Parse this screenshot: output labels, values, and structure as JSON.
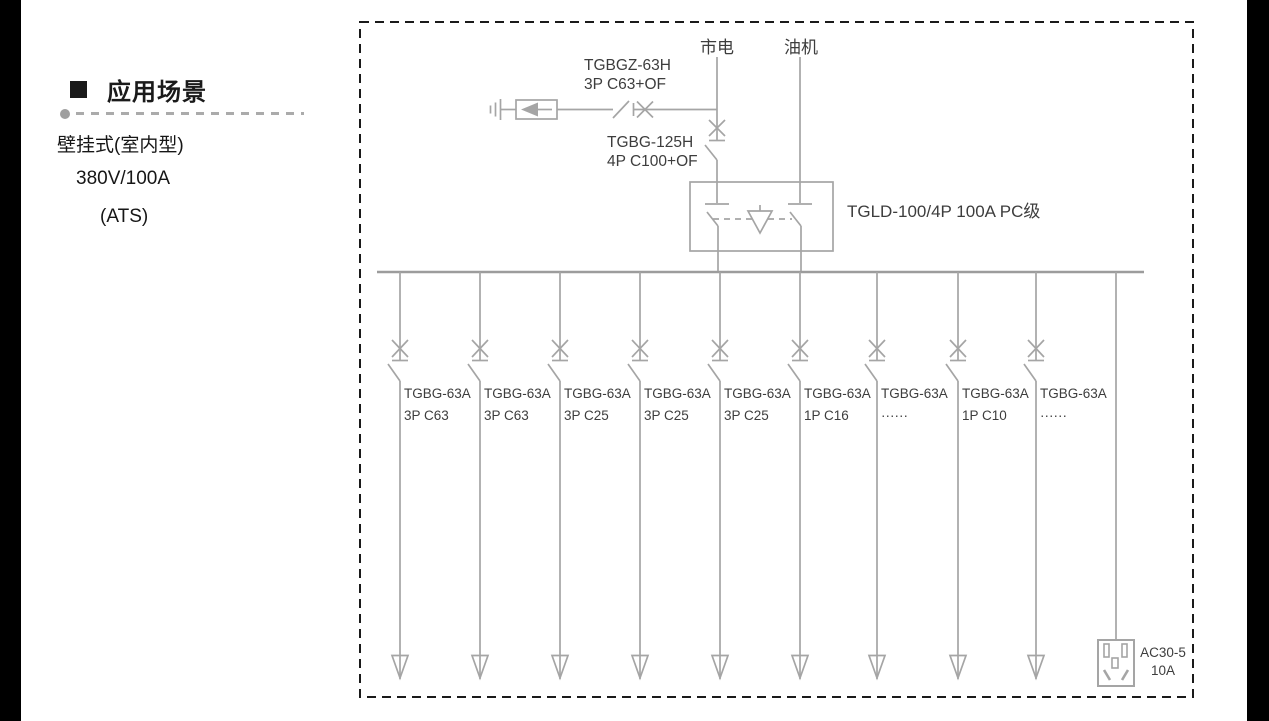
{
  "left_panel": {
    "heading": "应用场景",
    "mount_type": "壁挂式(室内型)",
    "rating": "380V/100A",
    "mode": "(ATS)"
  },
  "diagram": {
    "mains_label": "市电",
    "generator_label": "油机",
    "spd_branch_breaker": {
      "model": "TGBGZ-63H",
      "spec": "3P C63+OF"
    },
    "main_breaker": {
      "model": "TGBG-125H",
      "spec": "4P C100+OF"
    },
    "ats_label": "TGLD-100/4P 100A PC级",
    "branches": [
      {
        "model": "TGBG-63A",
        "spec": "3P C63"
      },
      {
        "model": "TGBG-63A",
        "spec": "3P C63"
      },
      {
        "model": "TGBG-63A",
        "spec": "3P C25"
      },
      {
        "model": "TGBG-63A",
        "spec": "3P C25"
      },
      {
        "model": "TGBG-63A",
        "spec": "3P C25"
      },
      {
        "model": "TGBG-63A",
        "spec": "1P C16"
      },
      {
        "model": "TGBG-63A",
        "spec": "······"
      },
      {
        "model": "TGBG-63A",
        "spec": "1P C10"
      },
      {
        "model": "TGBG-63A",
        "spec": "······"
      }
    ],
    "socket": {
      "model": "AC30-5",
      "rating": "10A"
    },
    "colors": {
      "line": "#a5a5a5",
      "text": "#3d3d3d",
      "border": "#1a1a1a"
    }
  }
}
